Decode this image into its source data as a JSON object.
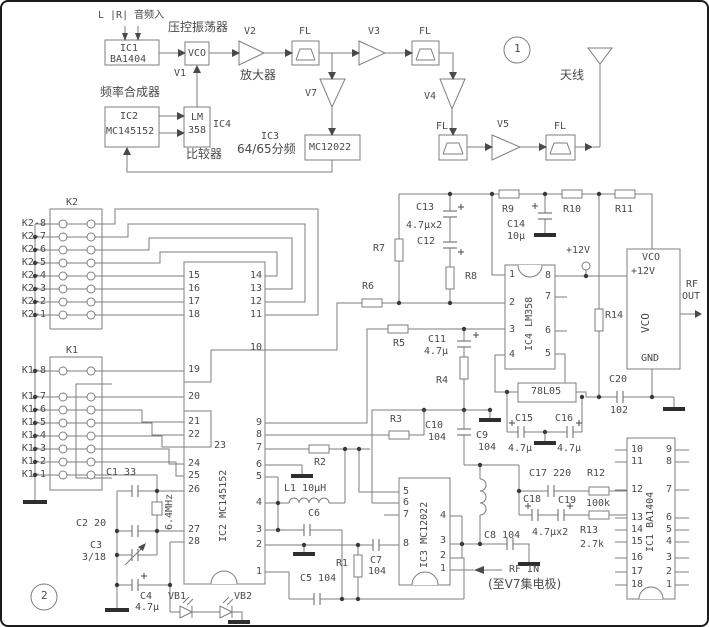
{
  "s1": {
    "n1": "1",
    "audio": "L |R| 音频入",
    "vcocn": "压控振荡器",
    "ic1a": "IC1",
    "ic1b": "BA1404",
    "vco": "VCO",
    "v1": "V1",
    "v2": "V2",
    "v3": "V3",
    "v4": "V4",
    "v5": "V5",
    "v7": "V7",
    "amp": "放大器",
    "fl": "FL",
    "fsyn": "频率合成器",
    "ic2a": "IC2",
    "ic2b": "MC145152",
    "lma": "LM",
    "lmb": "358",
    "ic4": "IC4",
    "comp": "比较器",
    "ic3": "IC3",
    "divider": "64/65分频",
    "mc": "MC12022",
    "ant": "天线"
  },
  "s2": {
    "n2": "2",
    "k2": "K2",
    "k1": "K1",
    "k2r": [
      "K2-8",
      "K2-7",
      "K2-6",
      "K2-5",
      "K2-4",
      "K2-3",
      "K2-2",
      "K2-1"
    ],
    "k1r": [
      "K1-8",
      "K1-7",
      "K1-6",
      "K1-5",
      "K1-4",
      "K1-3",
      "K1-2",
      "K1-1"
    ],
    "ic2name": "IC2 MC145152",
    "ic2pl": [
      "15",
      "16",
      "17",
      "18",
      "19",
      "20",
      "21",
      "22",
      "23",
      "24",
      "25",
      "26",
      "27",
      "28"
    ],
    "ic2pr": [
      "14",
      "13",
      "12",
      "11",
      "10",
      "9",
      "8",
      "7",
      "6",
      "5",
      "4",
      "3",
      "2",
      "1"
    ],
    "ic3name": "IC3 MC12022",
    "ic3pl": [
      "5",
      "6",
      "7",
      "8"
    ],
    "ic3pr": [
      "4",
      "3",
      "2",
      "1"
    ],
    "ic4name": "IC4 LM358",
    "ic4pl": [
      "1",
      "2",
      "3",
      "4"
    ],
    "ic4pr": [
      "8",
      "7",
      "6",
      "5"
    ],
    "ic1name": "IC1 BA1404",
    "ic1pl": [
      "10",
      "11",
      "12",
      "13",
      "14",
      "15",
      "16",
      "17",
      "18"
    ],
    "ic1pr": [
      "9",
      "8",
      "7",
      "6",
      "5",
      "4",
      "3",
      "2",
      "1"
    ],
    "c": {
      "c1": "C1 33",
      "xtal": "6.4MHz",
      "c2": "C2 20",
      "c3": "C3",
      "c3v": "3/18",
      "c4": "C4",
      "c4v": "4.7μ",
      "vb1": "VB1",
      "vb2": "VB2",
      "r1": "R1",
      "c5": "C5 104",
      "c6": "C6",
      "c7": "C7",
      "c7v": "104",
      "l1": "L1 10μH",
      "r2": "R2",
      "r3": "R3",
      "c10": "C10",
      "c10v": "104",
      "c9": "C9",
      "c9v": "104",
      "r4": "R4",
      "r5": "R5",
      "c11": "C11",
      "c11v": "4.7μ",
      "r6": "R6",
      "r7": "R7",
      "c13": "C13",
      "c1312v": "4.7μx2",
      "c12": "C12",
      "r8": "R8",
      "r9": "R9",
      "c14": "C14",
      "c14v": "10μ",
      "r10": "R10",
      "r11": "R11",
      "r14": "R14",
      "c20": "C20",
      "c20v": "102",
      "reg": "78L05",
      "c15": "C15",
      "c15v": "4.7μ",
      "c16": "C16",
      "c16v": "4.7μ",
      "c17": "C17 220",
      "c18": "C18",
      "c19": "C19",
      "c1819v": "4.7μx2",
      "r12": "R12",
      "r12v": "100k",
      "r13": "R13",
      "r13v": "2.7k",
      "c8": "C8 104",
      "rfin": "RF IN",
      "rfnote": "(至V7集电极)",
      "p12": "+12V"
    },
    "vco": {
      "t1": "VCO",
      "t2": "+12V",
      "mid": "VCO",
      "gnd": "GND",
      "rf1": "RF",
      "rf2": "OUT"
    }
  }
}
